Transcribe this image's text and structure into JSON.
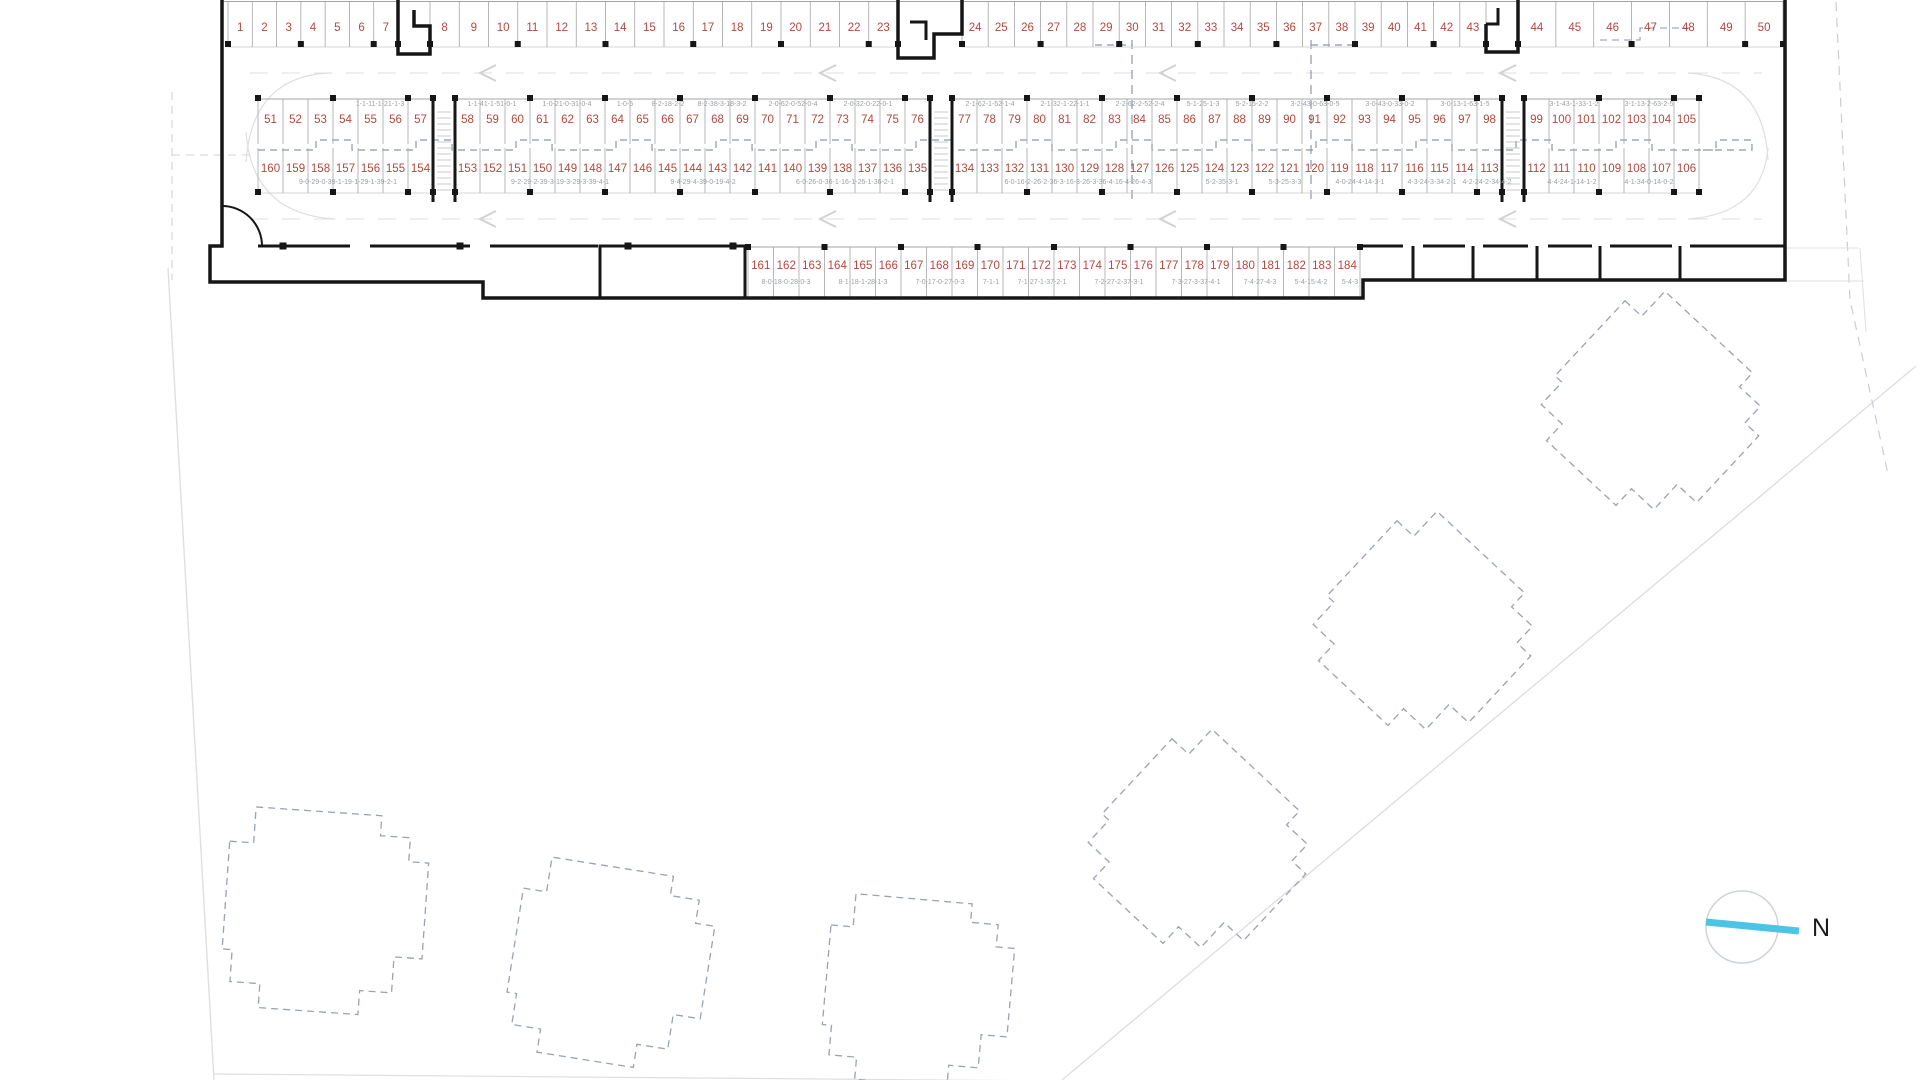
{
  "drawing": {
    "type": "parking-garage-floor-plan",
    "compass_label": "N",
    "colors": {
      "space_number": "#b0493d",
      "unit_code": "#9aa0a4",
      "wall": "#161616",
      "stall_line": "#a5a5a5",
      "light_line": "#dfdfdf",
      "dash_blue": "#8e96a8",
      "footprint_dash": "#9aa3ae",
      "compass_cyan": "#4cc4e6",
      "north_text": "#1c1c1c"
    },
    "top_row": {
      "y_number": 31,
      "y_top": 2,
      "y_bottom": 47,
      "groups": [
        {
          "x1": 228,
          "x2": 398,
          "numbers": [
            "1",
            "2",
            "3",
            "4",
            "5",
            "6",
            "7"
          ]
        },
        {
          "x1": 430,
          "x2": 898,
          "numbers": [
            "8",
            "9",
            "10",
            "11",
            "12",
            "13",
            "14",
            "15",
            "16",
            "17",
            "18",
            "19",
            "20",
            "21",
            "22",
            "23"
          ]
        },
        {
          "x1": 962,
          "x2": 1486,
          "numbers": [
            "24",
            "25",
            "26",
            "27",
            "28",
            "29",
            "30",
            "31",
            "32",
            "33",
            "34",
            "35",
            "36",
            "37",
            "38",
            "39",
            "40",
            "41",
            "42",
            "43"
          ]
        },
        {
          "x1": 1518,
          "x2": 1783,
          "numbers": [
            "44",
            "45",
            "46",
            "47",
            "48",
            "49",
            "50"
          ]
        }
      ]
    },
    "island_top": {
      "y_number": 123,
      "y_top": 99,
      "y_bottom": 144,
      "groups": [
        {
          "x1": 258,
          "x2": 433,
          "numbers": [
            "51",
            "52",
            "53",
            "54",
            "55",
            "56",
            "57"
          ]
        },
        {
          "x1": 455,
          "x2": 930,
          "numbers": [
            "58",
            "59",
            "60",
            "61",
            "62",
            "63",
            "64",
            "65",
            "66",
            "67",
            "68",
            "69",
            "70",
            "71",
            "72",
            "73",
            "74",
            "75",
            "76"
          ]
        },
        {
          "x1": 952,
          "x2": 1502,
          "numbers": [
            "77",
            "78",
            "79",
            "80",
            "81",
            "82",
            "83",
            "84",
            "85",
            "86",
            "87",
            "88",
            "89",
            "90",
            "91",
            "92",
            "93",
            "94",
            "95",
            "96",
            "97",
            "98"
          ]
        },
        {
          "x1": 1524,
          "x2": 1699,
          "numbers": [
            "99",
            "100",
            "101",
            "102",
            "103",
            "104",
            "105"
          ]
        }
      ]
    },
    "island_bottom": {
      "y_number": 172,
      "y_top": 148,
      "y_bottom": 193,
      "groups": [
        {
          "x1": 258,
          "x2": 433,
          "numbers": [
            "160",
            "159",
            "158",
            "157",
            "156",
            "155",
            "154"
          ]
        },
        {
          "x1": 455,
          "x2": 930,
          "numbers": [
            "153",
            "152",
            "151",
            "150",
            "149",
            "148",
            "147",
            "146",
            "145",
            "144",
            "143",
            "142",
            "141",
            "140",
            "139",
            "138",
            "137",
            "136",
            "135"
          ]
        },
        {
          "x1": 952,
          "x2": 1502,
          "numbers": [
            "134",
            "133",
            "132",
            "131",
            "130",
            "129",
            "128",
            "127",
            "126",
            "125",
            "124",
            "123",
            "122",
            "121",
            "120",
            "119",
            "118",
            "117",
            "116",
            "115",
            "114",
            "113"
          ]
        },
        {
          "x1": 1524,
          "x2": 1699,
          "numbers": [
            "112",
            "111",
            "110",
            "109",
            "108",
            "107",
            "106"
          ]
        }
      ]
    },
    "bottom_row": {
      "y_number": 269,
      "y_top": 247,
      "y_bottom": 297,
      "groups": [
        {
          "x1": 748,
          "x2": 1360,
          "numbers": [
            "161",
            "162",
            "163",
            "164",
            "165",
            "166",
            "167",
            "168",
            "169",
            "170",
            "171",
            "172",
            "173",
            "174",
            "175",
            "176",
            "177",
            "178",
            "179",
            "180",
            "181",
            "182",
            "183",
            "184"
          ]
        }
      ]
    },
    "codes_island_top": {
      "y": 106,
      "items": [
        {
          "t": "1-1-11-1-21-1-3",
          "x": 380
        },
        {
          "t": "1-1-41-1-51-0-1",
          "x": 492
        },
        {
          "t": "1-0-21-0-31-0-4",
          "x": 567
        },
        {
          "t": "1-0-5",
          "x": 625
        },
        {
          "t": "8-2-18-2-2",
          "x": 668
        },
        {
          "t": "8-2-38-3-18-3-2",
          "x": 722
        },
        {
          "t": "2-0-62-0-52-0-4",
          "x": 793
        },
        {
          "t": "2-0-32-0-22-0-1",
          "x": 868
        },
        {
          "t": "2-1-62-1-52-1-4",
          "x": 990
        },
        {
          "t": "2-1-32-1-22-1-1",
          "x": 1065
        },
        {
          "t": "2-2-62-2-52-2-4",
          "x": 1140
        },
        {
          "t": "5-1-25-1-3",
          "x": 1203
        },
        {
          "t": "5-2-15-2-2",
          "x": 1252
        },
        {
          "t": "3-2-43-0-63-0-5",
          "x": 1315
        },
        {
          "t": "3-0-43-0-33-0-2",
          "x": 1390
        },
        {
          "t": "3-0-13-1-63-1-5",
          "x": 1465
        },
        {
          "t": "3-1-43-1-33-1-2",
          "x": 1574
        },
        {
          "t": "3-1-13-2-63-2-5",
          "x": 1649
        }
      ]
    },
    "codes_island_bottom": {
      "y": 184,
      "items": [
        {
          "t": "9-0-29-0-39-1-19-1-29-1-39-2-1",
          "x": 348
        },
        {
          "t": "9-2-29-2-39-3-19-3-29-3-39-4-1",
          "x": 560
        },
        {
          "t": "9-4-29-4-39-0-19-4-2",
          "x": 703
        },
        {
          "t": "6-0-26-0-36-1-16-1-26-1-36-2-1",
          "x": 845
        },
        {
          "t": "6-0-16-2-26-2-36-3-16-3-26-3-36-4-16-4-26-4-3",
          "x": 1078
        },
        {
          "t": "5-2-35-3-1",
          "x": 1222
        },
        {
          "t": "5-3-25-3-3",
          "x": 1285
        },
        {
          "t": "4-0-24-4-14-3-1",
          "x": 1360
        },
        {
          "t": "4-3-24-3-34-2-1",
          "x": 1432
        },
        {
          "t": "4-2-24-2-34-4-2",
          "x": 1487
        },
        {
          "t": "4-4-24-1-14-1-2",
          "x": 1572
        },
        {
          "t": "4-1-34-0-14-0-2",
          "x": 1649
        }
      ]
    },
    "codes_bottom_row": {
      "y": 284,
      "items": [
        {
          "t": "8-0-18-0-28-0-3",
          "x": 786
        },
        {
          "t": "8-1-18-1-28-1-3",
          "x": 863
        },
        {
          "t": "7-0-17-0-27-0-3",
          "x": 940
        },
        {
          "t": "7-1-1",
          "x": 991
        },
        {
          "t": "7-1-27-1-37-2-1",
          "x": 1042
        },
        {
          "t": "7-2-27-2-37-3-1",
          "x": 1119
        },
        {
          "t": "7-3-27-3-37-4-1",
          "x": 1196
        },
        {
          "t": "7-4-27-4-3",
          "x": 1260
        },
        {
          "t": "5-4-15-4-2",
          "x": 1311
        },
        {
          "t": "5-4-3",
          "x": 1350
        }
      ]
    },
    "stair_shafts_x": [
      433,
      930,
      1502
    ],
    "footprint_blocks": [
      {
        "cx": 325,
        "cy": 912,
        "s": 200,
        "rot": 4
      },
      {
        "cx": 610,
        "cy": 965,
        "s": 195,
        "rot": 9
      },
      {
        "cx": 918,
        "cy": 992,
        "s": 185,
        "rot": 5
      },
      {
        "cx": 1200,
        "cy": 848,
        "s": 190,
        "rot": 43
      },
      {
        "cx": 1425,
        "cy": 630,
        "s": 190,
        "rot": 43
      },
      {
        "cx": 1653,
        "cy": 410,
        "s": 190,
        "rot": 43
      }
    ],
    "compass": {
      "cx": 1742,
      "cy": 927,
      "r": 36,
      "label_x": 1812,
      "label_y": 936
    }
  }
}
